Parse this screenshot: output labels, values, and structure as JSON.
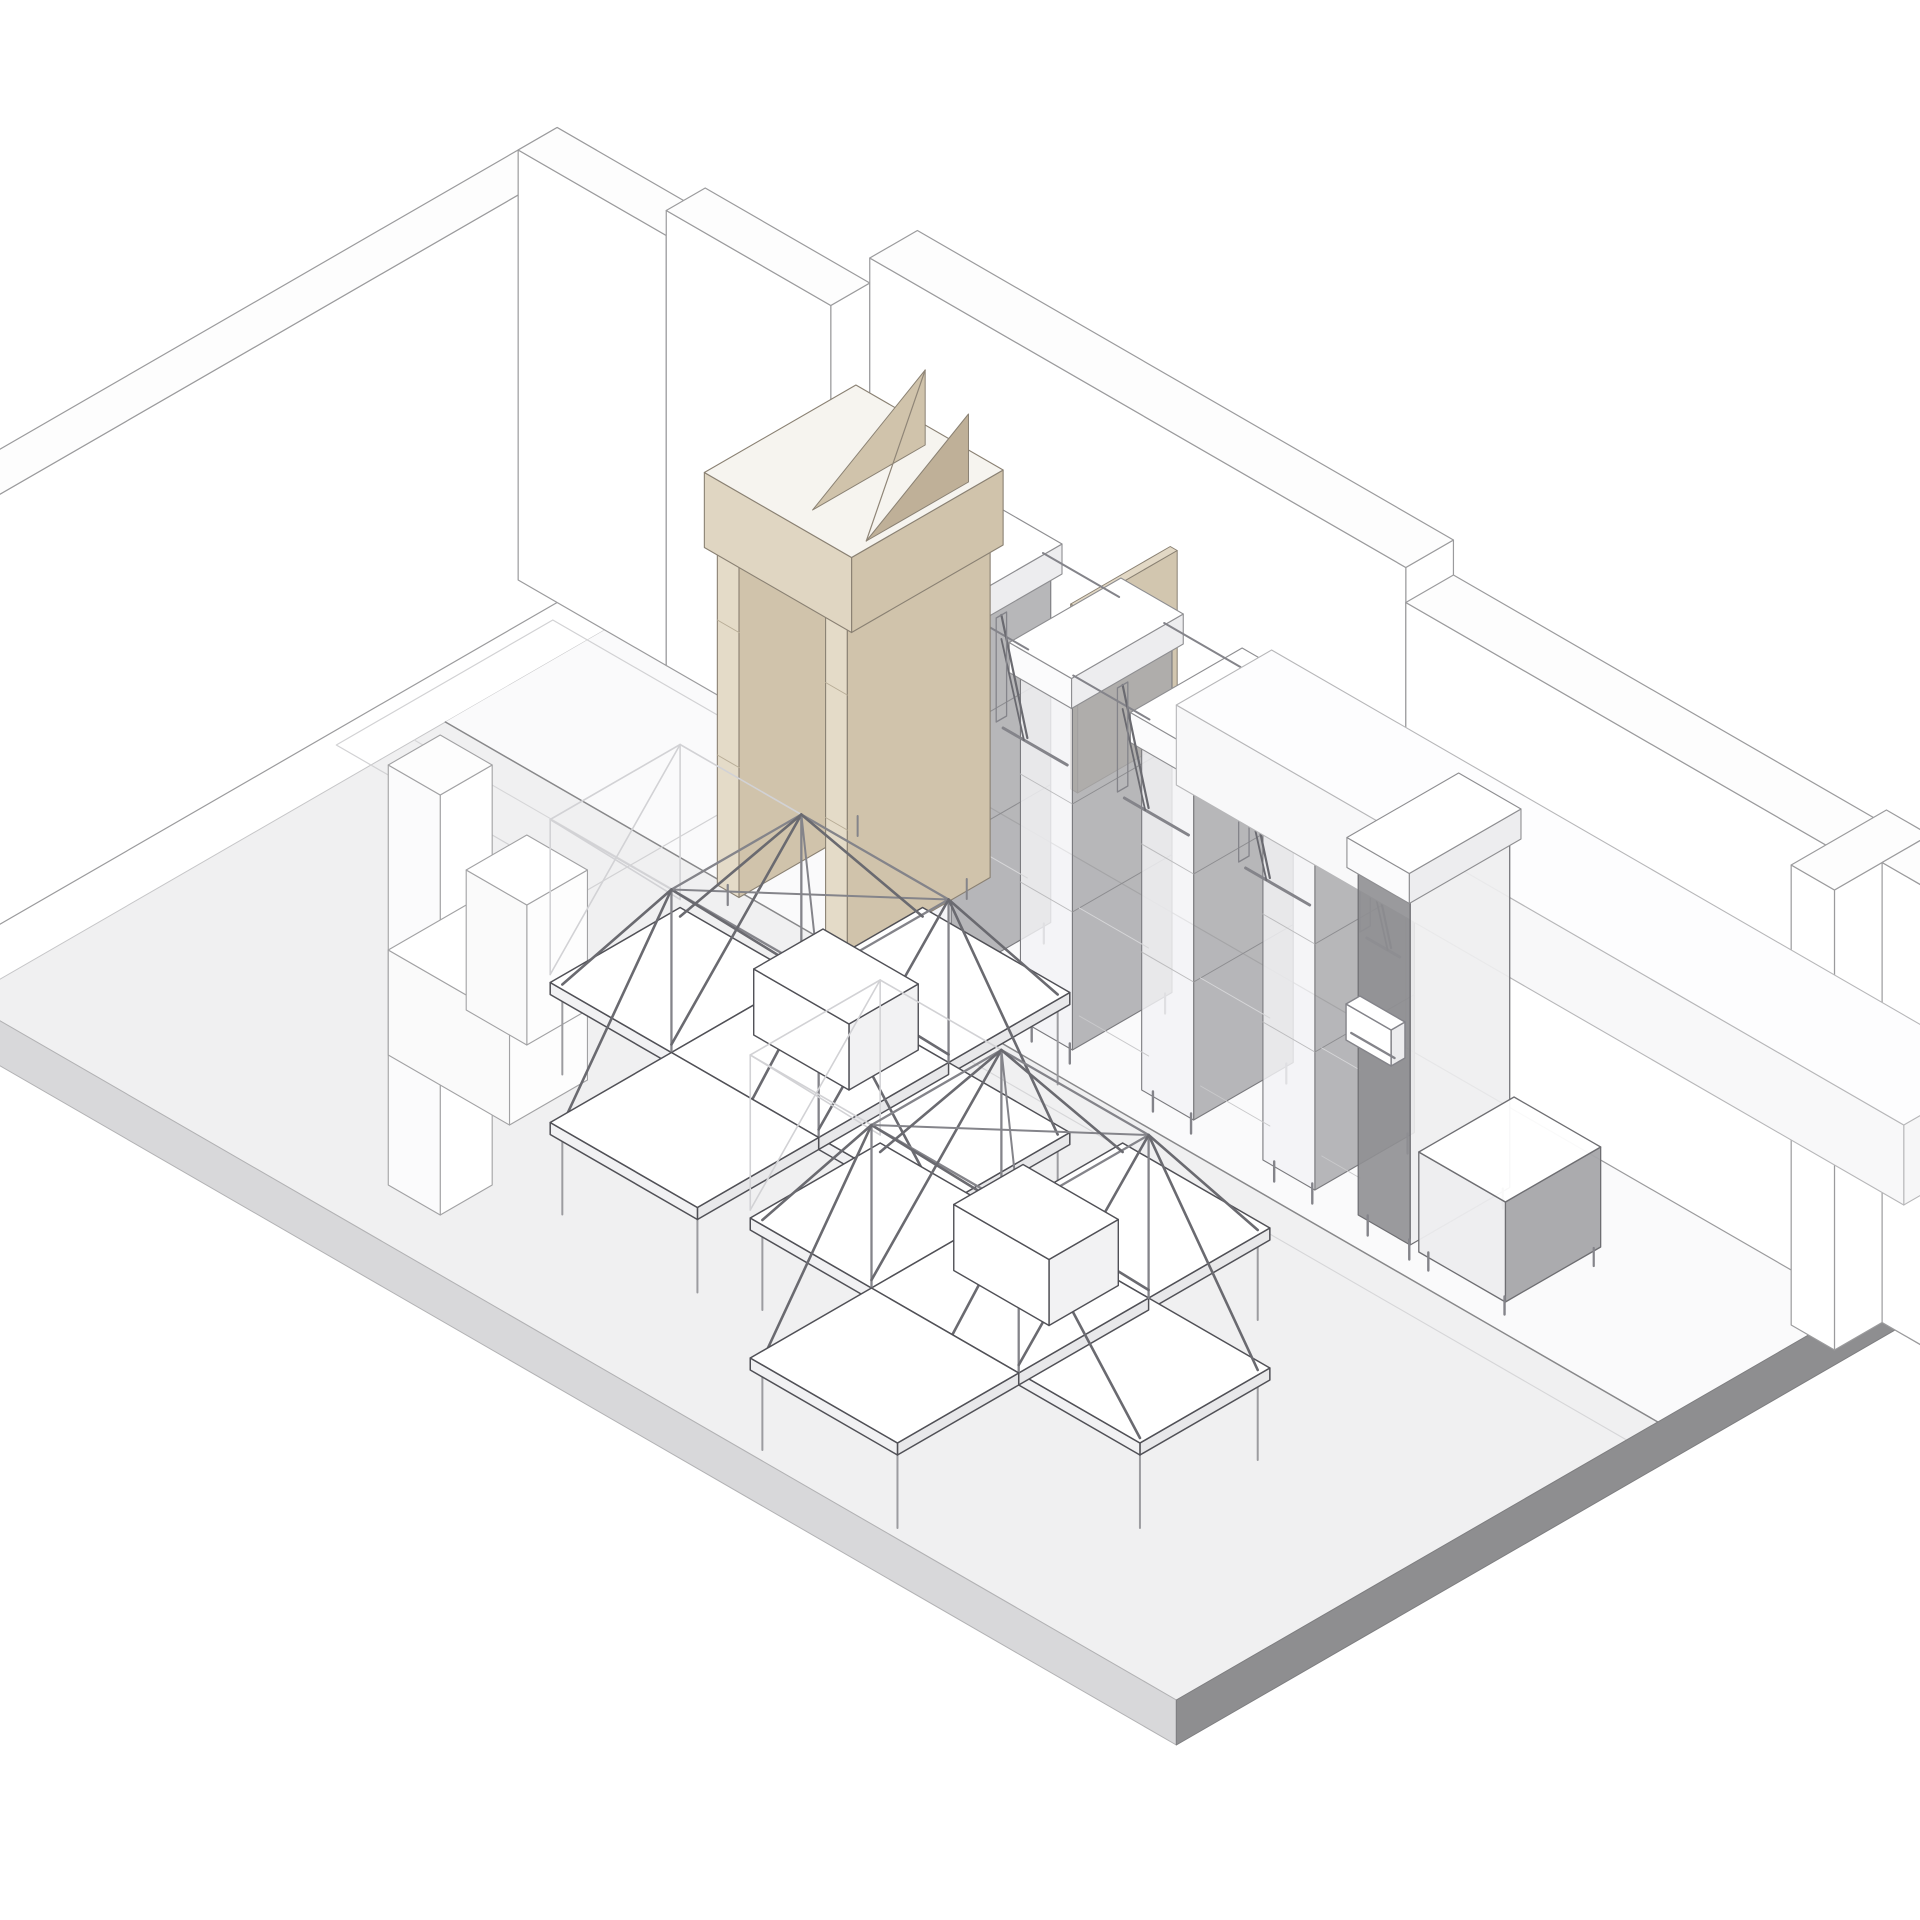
{
  "drawing": {
    "title": "axonometric-retail-interior",
    "projection": {
      "cx": 726,
      "cy": 560,
      "ux": 0.866,
      "uy": 0.5
    },
    "elements": [
      {
        "n": "floor-slab-top",
        "k": "poly",
        "p": [
          [
            0,
            0,
            0
          ],
          [
            1400,
            0,
            0
          ],
          [
            1400,
            880,
            0
          ],
          [
            0,
            880,
            0
          ]
        ],
        "f": "floorTop",
        "s": "#c6c6c8",
        "w": 1
      },
      {
        "n": "floor-zone-back",
        "k": "poly",
        "p": [
          [
            0,
            0,
            0
          ],
          [
            1400,
            0,
            0
          ],
          [
            1400,
            324,
            0
          ],
          [
            0,
            324,
            0
          ]
        ],
        "f": "floorBack",
        "s": null,
        "w": 0
      },
      {
        "n": "floor-seam-dark",
        "k": "line",
        "p": [
          [
            0,
            324,
            0
          ],
          [
            1400,
            324,
            0
          ]
        ],
        "s": "seamDark",
        "w": 1.5
      },
      {
        "n": "floor-seam-light",
        "k": "line",
        "p": [
          [
            0,
            360,
            0
          ],
          [
            1400,
            360,
            0
          ]
        ],
        "s": "seamLight",
        "w": 1.1
      },
      {
        "n": "floor-slab-edge-left",
        "k": "poly",
        "p": [
          [
            0,
            880,
            0
          ],
          [
            1400,
            880,
            0
          ],
          [
            1400,
            880,
            -45
          ],
          [
            0,
            880,
            -45
          ]
        ],
        "f": "slabEdgeL",
        "s": "#b2b2b4",
        "w": 1
      },
      {
        "n": "floor-slab-edge-right",
        "k": "poly",
        "p": [
          [
            1400,
            0,
            -45
          ],
          [
            1400,
            880,
            -45
          ],
          [
            1400,
            880,
            0
          ],
          [
            1400,
            0,
            0
          ]
        ],
        "f": "slabEdgeR",
        "s": "#7e7e80",
        "w": 1
      },
      {
        "n": "wall-left",
        "k": "box",
        "b": [
          -100,
          95,
          0,
          45,
          885,
          430
        ],
        "t": "wallTop",
        "r": "#ffffff",
        "l": "#fcfcfd",
        "s": "wallStroke",
        "w": 1.2
      },
      {
        "n": "wall-back-a",
        "k": "box",
        "b": [
          -100,
          95,
          0,
          171,
          45,
          430
        ],
        "t": "wallTop",
        "r": "#ffffff",
        "l": "#ffffff",
        "s": "wallStroke",
        "w": 1.2
      },
      {
        "n": "wall-back-b",
        "k": "box",
        "b": [
          71,
          95,
          0,
          190,
          45,
          455
        ],
        "t": "wallTop",
        "r": "#ffffff",
        "l": "#ffffff",
        "s": "wallStroke",
        "w": 1.2
      },
      {
        "n": "wall-back-c1",
        "k": "box",
        "b": [
          261,
          40,
          0,
          619,
          55,
          480
        ],
        "t": "wallTop",
        "r": "#ffffff",
        "l": "#ffffff",
        "s": "wallStroke",
        "w": 1.2
      },
      {
        "n": "wall-back-c2",
        "k": "box",
        "b": [
          880,
          40,
          0,
          680,
          55,
          445
        ],
        "t": "wallTop",
        "r": "#ffffff",
        "l": "#ffffff",
        "s": "wallStroke",
        "w": 1.2
      },
      {
        "n": "wall-right",
        "k": "box",
        "b": [
          1380,
          40,
          0,
          50,
          110,
          460
        ],
        "t": "wallTop",
        "r": "#ffffff",
        "l": "#ffffff",
        "s": "wallStroke",
        "w": 1.2
      },
      {
        "n": "wall-right-return",
        "k": "box",
        "b": [
          1430,
          40,
          0,
          400,
          55,
          460
        ],
        "t": "wallTop",
        "r": "#ffffff",
        "l": "#ffffff",
        "s": "wallStroke",
        "w": 1.2
      },
      {
        "n": "backroom-floor-outline",
        "k": "poly",
        "p": [
          [
            -40,
            160,
            0
          ],
          [
            250,
            160,
            0
          ],
          [
            250,
            410,
            0
          ],
          [
            -40,
            410,
            0
          ]
        ],
        "f": null,
        "s": "lightStroke",
        "w": 1.2
      },
      {
        "n": "wood-divider-panel",
        "k": "box",
        "b": [
          708,
          195,
          280,
          8,
          115,
          185
        ],
        "t": "wood",
        "r": "woodSide",
        "l": "woodDark",
        "s": "woodStroke",
        "w": 1,
        "o": 0.95
      },
      {
        "n": "shelf-tower-1",
        "k": "tower",
        "x": 510
      },
      {
        "n": "shelf-tower-2",
        "k": "tower",
        "x": 650
      },
      {
        "n": "shelf-tower-3",
        "k": "tower",
        "x": 790
      },
      {
        "n": "shelf-tower-4",
        "k": "tower",
        "x": 930
      },
      {
        "n": "rail-bay-1",
        "k": "bay",
        "x": 570,
        "len": 80
      },
      {
        "n": "rail-bay-2",
        "k": "bay",
        "x": 710,
        "len": 80
      },
      {
        "n": "rail-bay-3",
        "k": "bay",
        "x": 850,
        "len": 80
      },
      {
        "n": "rail-bay-4",
        "k": "bay",
        "x": 990,
        "len": 44
      },
      {
        "n": "ceiling-beam",
        "k": "box",
        "b": [
          780,
          150,
          295,
          840,
          110,
          80
        ],
        "t": "#fdfdfe",
        "r": "#f6f6f7",
        "l": "#f8f8f9",
        "s": "#b7b7b9",
        "w": 1.1
      },
      {
        "n": "end-fixture-body",
        "k": "box",
        "b": [
          1040,
          195,
          20,
          60,
          115,
          348
        ],
        "t": "#f7f7f8",
        "r": "#eeeef0",
        "l": "panelGrayDark",
        "s": "#6e6e72",
        "w": 1.2,
        "o": 0.9
      },
      {
        "n": "end-fixture-cap",
        "k": "box",
        "b": [
          1034,
          188,
          368,
          72,
          129,
          30
        ],
        "t": "#ffffff",
        "r": "#ededef",
        "l": "#fbfbfc",
        "s": "#8e8e91",
        "w": 1.1
      },
      {
        "n": "end-fixture-leg-1",
        "k": "line",
        "p": [
          [
            1046,
            305,
            0
          ],
          [
            1046,
            305,
            20
          ]
        ],
        "s": "steel",
        "w": 2.4
      },
      {
        "n": "end-fixture-leg-2",
        "k": "line",
        "p": [
          [
            1094,
            305,
            0
          ],
          [
            1094,
            305,
            20
          ]
        ],
        "s": "steel",
        "w": 2.4
      },
      {
        "n": "end-fixture-leg-3",
        "k": "line",
        "p": [
          [
            1097,
            200,
            0
          ],
          [
            1097,
            200,
            20
          ]
        ],
        "s": "steel",
        "w": 2.2
      },
      {
        "n": "end-fixture-ledge",
        "k": "box",
        "b": [
          1044,
          312,
          206,
          52,
          16,
          36
        ],
        "t": "#ffffff",
        "r": "#ececee",
        "l": "#ffffff",
        "s": "steel",
        "w": 1.4
      },
      {
        "n": "end-fixture-ledge-rod",
        "k": "line",
        "p": [
          [
            1046,
            324,
            212
          ],
          [
            1096,
            324,
            212
          ]
        ],
        "s": "steel",
        "w": 2.4
      },
      {
        "n": "base-cabinet",
        "k": "box",
        "b": [
          1110,
          200,
          18,
          100,
          110,
          100
        ],
        "t": "#ffffff",
        "r": "panelGray",
        "l": "#ededef",
        "s": "#6e6e72",
        "w": 1.3,
        "o": 0.95
      },
      {
        "n": "base-cabinet-leg-1",
        "k": "line",
        "p": [
          [
            1116,
            305,
            0
          ],
          [
            1116,
            305,
            18
          ]
        ],
        "s": "steel",
        "w": 2.4
      },
      {
        "n": "base-cabinet-leg-2",
        "k": "line",
        "p": [
          [
            1204,
            305,
            0
          ],
          [
            1204,
            305,
            18
          ]
        ],
        "s": "steel",
        "w": 2.4
      },
      {
        "n": "base-cabinet-leg-3",
        "k": "line",
        "p": [
          [
            1207,
            205,
            0
          ],
          [
            1207,
            205,
            18
          ]
        ],
        "s": "steel",
        "w": 2.2
      },
      {
        "n": "portal-back-panel",
        "k": "box",
        "b": [
          345,
          200,
          20,
          140,
          10,
          410
        ],
        "t": "wood",
        "r": "woodSide",
        "l": "woodDark",
        "s": "woodStroke",
        "w": 1,
        "o": 0.95
      },
      {
        "n": "portal-shelf-1",
        "k": "line",
        "p": [
          [
            352,
            212,
            130
          ],
          [
            480,
            212,
            130
          ]
        ],
        "s": "#9a8f7c",
        "w": 1.4
      },
      {
        "n": "portal-shelf-2",
        "k": "line",
        "p": [
          [
            352,
            212,
            240
          ],
          [
            480,
            212,
            240
          ]
        ],
        "s": "#9a8f7c",
        "w": 1.4
      },
      {
        "n": "portal-shelf-3",
        "k": "line",
        "p": [
          [
            352,
            212,
            330
          ],
          [
            480,
            212,
            330
          ]
        ],
        "s": "#9a8f7c",
        "w": 1.4
      },
      {
        "n": "portal-divider",
        "k": "line",
        "p": [
          [
            416,
            212,
            22
          ],
          [
            416,
            212,
            352
          ]
        ],
        "s": "#9a8f7c",
        "w": 1.4
      },
      {
        "n": "portal-post-left",
        "k": "box",
        "b": [
          340,
          185,
          20,
          25,
          165,
          410
        ],
        "t": "#fafafa",
        "r": "woodSide",
        "l": "woodLight",
        "s": "woodStroke",
        "w": 1.1
      },
      {
        "n": "portal-post-right",
        "k": "box",
        "b": [
          465,
          185,
          20,
          25,
          165,
          410
        ],
        "t": "#fafafa",
        "r": "woodSide",
        "l": "woodLight",
        "s": "woodStroke",
        "w": 1.1
      },
      {
        "n": "portal-joint-1",
        "k": "line",
        "p": [
          [
            340,
            350,
            150
          ],
          [
            365,
            350,
            150
          ]
        ],
        "s": "#b8ad97",
        "w": 1
      },
      {
        "n": "portal-joint-2",
        "k": "line",
        "p": [
          [
            340,
            350,
            285
          ],
          [
            365,
            350,
            285
          ]
        ],
        "s": "#b8ad97",
        "w": 1
      },
      {
        "n": "portal-joint-3",
        "k": "line",
        "p": [
          [
            465,
            350,
            150
          ],
          [
            490,
            350,
            150
          ]
        ],
        "s": "#b8ad97",
        "w": 1
      },
      {
        "n": "portal-joint-4",
        "k": "line",
        "p": [
          [
            465,
            350,
            285
          ],
          [
            490,
            350,
            285
          ]
        ],
        "s": "#b8ad97",
        "w": 1
      },
      {
        "n": "portal-leg-1",
        "k": "line",
        "p": [
          [
            346,
            344,
            0
          ],
          [
            346,
            344,
            20
          ]
        ],
        "s": "steel",
        "w": 2.2
      },
      {
        "n": "portal-leg-2",
        "k": "line",
        "p": [
          [
            484,
            344,
            0
          ],
          [
            484,
            344,
            20
          ]
        ],
        "s": "steel",
        "w": 2.2
      },
      {
        "n": "portal-leg-3",
        "k": "line",
        "p": [
          [
            352,
            200,
            0
          ],
          [
            352,
            200,
            20
          ]
        ],
        "s": "steel",
        "w": 2
      },
      {
        "n": "portal-leg-4",
        "k": "line",
        "p": [
          [
            478,
            200,
            0
          ],
          [
            478,
            200,
            20
          ]
        ],
        "s": "steel",
        "w": 2
      },
      {
        "n": "portal-lintel",
        "k": "box",
        "b": [
          330,
          180,
          355,
          170,
          175,
          75
        ],
        "t": "woodTop",
        "r": "woodSide",
        "l": "wood",
        "s": "woodStroke",
        "w": 1.1
      },
      {
        "n": "portal-wedge-a",
        "k": "poly",
        "p": [
          [
            430,
            200,
            430
          ],
          [
            430,
            330,
            430
          ],
          [
            430,
            200,
            505
          ]
        ],
        "f": "woodSide",
        "s": "woodStroke",
        "w": 1
      },
      {
        "n": "portal-wedge-b",
        "k": "poly",
        "p": [
          [
            492,
            212,
            430
          ],
          [
            492,
            330,
            430
          ],
          [
            492,
            212,
            498
          ]
        ],
        "f": "woodDark",
        "s": "woodStroke",
        "w": 1
      },
      {
        "n": "portal-wedge-brace",
        "k": "line",
        "p": [
          [
            430,
            200,
            505
          ],
          [
            492,
            330,
            430
          ]
        ],
        "s": "#8f8577",
        "w": 1.2
      },
      {
        "n": "partition-pier",
        "k": "box",
        "b": [
          430,
          760,
          0,
          60,
          60,
          420
        ],
        "t": "#fdfdfd",
        "r": "#ffffff",
        "l": "#fbfbfc",
        "s": "#a2a2a4",
        "w": 1.1
      },
      {
        "n": "counter-main",
        "k": "box",
        "b": [
          300,
          600,
          0,
          140,
          90,
          105
        ],
        "t": "#ffffff",
        "r": "#fdfdfd",
        "l": "#fafafa",
        "s": "#a2a2a4",
        "w": 1.1
      },
      {
        "n": "counter-return",
        "k": "box",
        "b": [
          300,
          530,
          0,
          70,
          70,
          140
        ],
        "t": "#ffffff",
        "r": "#fdfdfd",
        "l": "#fafafa",
        "s": "#a2a2a4",
        "w": 1.1
      },
      {
        "n": "display-table-1",
        "k": "table",
        "cx": 638,
        "cy": 541
      },
      {
        "n": "display-table-2",
        "k": "table",
        "cx": 989,
        "cy": 661
      }
    ]
  },
  "colors": {
    "bg": "#ffffff",
    "floorTop": "#f0f0f1",
    "floorBack": "#fafafb",
    "slabEdgeL": "#d8d8da",
    "slabEdgeR": "#8e8e90",
    "wallTop": "#fdfdfd",
    "wallStroke": "#9b9b9d",
    "lightStroke": "#d2d2d4",
    "seamDark": "#88888a",
    "seamLight": "#d6d6d8",
    "wood": "#e0d6c2",
    "woodSide": "#d0c3ab",
    "woodDark": "#bfb098",
    "woodTop": "#f6f4ef",
    "woodLight": "#e4dbc8",
    "woodStroke": "#8a8173",
    "panelGray": "#a7a7aa",
    "panelGrayDark": "#8f8f92",
    "towerFace": "#f3f3f5",
    "steel": "#84848a",
    "steelDark": "#6a6a70",
    "ghost": "#d2d2d5",
    "legStroke": "#9c9ca0",
    "tableStroke": "#505056"
  }
}
